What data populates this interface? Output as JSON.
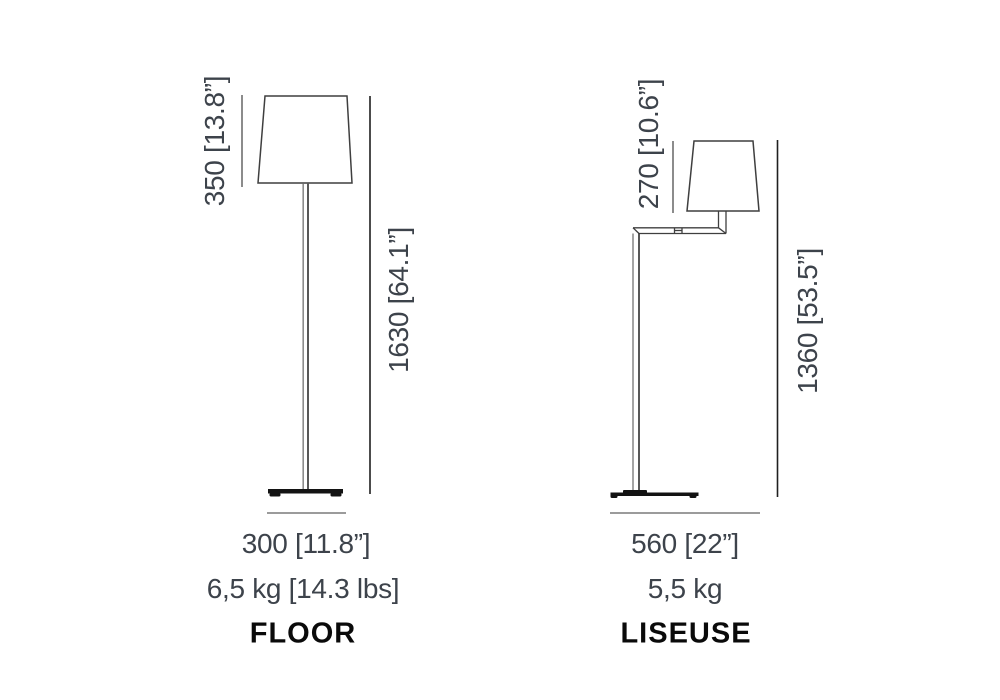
{
  "diagram": {
    "lamps": [
      {
        "name_label": "FLOOR",
        "shade_height_dim": "350 [13.8”]",
        "total_height_dim": "1630 [64.1”]",
        "width_dim": "300 [11.8”]",
        "weight": "6,5 kg [14.3 lbs]"
      },
      {
        "name_label": "LISEUSE",
        "shade_height_dim": "270 [10.6”]",
        "total_height_dim": "1360 [53.5”]",
        "width_dim": "560 [22”]",
        "weight": "5,5 kg"
      }
    ]
  },
  "colors": {
    "background": "#ffffff",
    "lamp_outline": "#3f3f3f",
    "base_fill": "#131313",
    "dim_line_dark": "#1f1f1f",
    "dim_line_medium": "#6f6f6f",
    "dim_line_light": "#9b9b9b",
    "dimension_text": "#3d434b",
    "name_text": "#0a0a0a"
  }
}
